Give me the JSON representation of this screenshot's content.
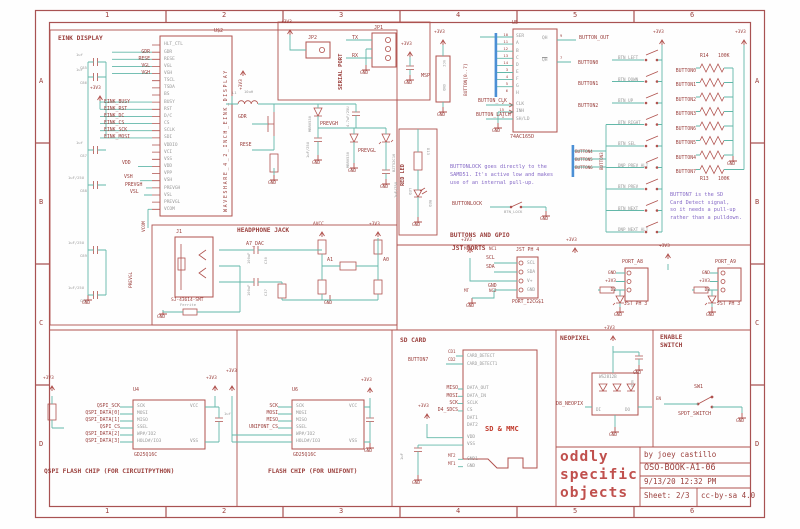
{
  "palette": {
    "symbol_red": "#b0524e",
    "label_maroon": "#9a3f3c",
    "wire_teal": "#63b8a9",
    "bus_blue": "#4b8fd5",
    "pin_gray": "#9a9a9a",
    "note_purple": "#8569c6",
    "logo_red": "#c0504d"
  },
  "sym": {
    "gnd": "GND",
    "v33": "+3V3",
    "avcc": "AVCC"
  },
  "frame": {
    "cols": [
      "1",
      "2",
      "3",
      "4",
      "5",
      "6"
    ],
    "rows": [
      "A",
      "B",
      "C",
      "D"
    ]
  },
  "title_block": {
    "logo": [
      "oddly",
      "specific",
      "objects"
    ],
    "by": "by joey castillo",
    "doc": "OSO-BOOK-A1-06",
    "date": "9/13/20 12:32 PM",
    "sheet_label": "Sheet:",
    "sheet_value": "2/3",
    "license": "cc-by-sa 4.0"
  },
  "eink": {
    "section": "EINK DISPLAY",
    "refdes": "U$2",
    "device": "WAVESHARE_4_2_INCH_EINK_DISPLAY",
    "pins": [
      "HLT_CTL",
      "GDR",
      "RESE",
      "VGL",
      "VGH",
      "TSCL",
      "TSDA",
      "BS",
      "BUSY",
      "RST",
      "D/C",
      "CS",
      "SCLK",
      "SDI",
      "VDDIO",
      "VCI",
      "VSS",
      "VDD",
      "VPP",
      "VSH",
      "PREVGH",
      "VSL",
      "PREVGL",
      "VCOM"
    ],
    "nets_top": [
      "GDR",
      "RESE",
      "VGL",
      "VGH"
    ],
    "nets_spi": [
      "EINK_BUSY",
      "EINK_RST",
      "EINK_DC",
      "EINK_CS",
      "EINK_SCK",
      "EINK_MOSI"
    ],
    "net_vdd": "VDD",
    "net_vsh": "VSH",
    "net_prevgh": "PREVGH",
    "net_vsl": "VSL",
    "net_vcom": "VCOM",
    "net_prevgl": "PREVGL",
    "cap_values": [
      "1uf",
      "1uf",
      "1uf",
      "1uF/25U",
      "1uF/25U",
      "1uF/25U"
    ],
    "cap_names": [
      "C85",
      "C86",
      "C87",
      "C88",
      "C89",
      "C90"
    ]
  },
  "boost": {
    "l_ref": "L1",
    "l_val": "10uH",
    "net_gdr": "GDR",
    "net_rese": "RESE",
    "net_prevgh": "PREVGH",
    "net_prevgl": "PREVGL",
    "d1": "MBR0530",
    "d2": "MBR0530",
    "dz": "BZT52C16",
    "c1": "1uF/25U",
    "c2": "4.7uF/25U",
    "c3": "1uF/25U"
  },
  "serial": {
    "section": "SERIAL PORT",
    "jp1": "JP1",
    "jp2": "JP2",
    "tx": "TX",
    "rx": "RX"
  },
  "msp": {
    "label": "MSP",
    "vcc": "VCC",
    "gnd": "GND"
  },
  "gpio": {
    "section": "BUTTONS AND GPIO",
    "refdes": "U5",
    "device": "74AC165D",
    "pins_in": [
      "SER",
      "A",
      "B",
      "C",
      "D",
      "E",
      "F",
      "G",
      "H"
    ],
    "pin_nums_in": [
      "10",
      "11",
      "12",
      "13",
      "14",
      "3",
      "4",
      "5",
      "6"
    ],
    "pins_ctl": [
      "CLK",
      "INH",
      "SH/LD"
    ],
    "pin_nums_ctl": [
      "2",
      "15",
      "1"
    ],
    "qh": "QH",
    "qh_num": "9",
    "qhn": "QH",
    "qhn_num": "7",
    "bus": "BUTTON[0..7]",
    "net_out": "BUTTON_OUT",
    "net_clk": "BUTTON_CLK",
    "net_latch": "BUTTON_LATCH",
    "note": [
      "BUTTONLOCK goes directly to the",
      "SAMD51. It's active low and makes",
      "use of an internal pull-up."
    ],
    "net_lock": "BUTTONLOCK",
    "sw_lock": "BTN_LOCK"
  },
  "buttons": {
    "nets_left": [
      "BUTTON0",
      "BUTTON1",
      "BUTTON2"
    ],
    "bus_nets": [
      "BUTTON4",
      "BUTTON5",
      "BUTTON6"
    ],
    "net_vert": "BUTTON3",
    "switches": [
      "BTN_LEFT",
      "BTN_DOWN",
      "BTN_UP",
      "BTN_RIGHT",
      "BTN_SEL",
      "DNP_PREV_ALT",
      "BTN_PREV",
      "BTN_NEXT",
      "DNP_NEXT_ALT"
    ],
    "array_nets": [
      "BUTTON0",
      "BUTTON1",
      "BUTTON2",
      "BUTTON3",
      "BUTTON6",
      "BUTTON5",
      "BUTTON4",
      "BUTTON7"
    ],
    "r_top": "R14",
    "r_top_val": "100K",
    "r_bot": "R13",
    "r_bot_val": "100K",
    "note": [
      "BUTTON7 is the SD",
      "Card Detect signal,",
      "so it needs a pull-up",
      "rather than a pulldown."
    ]
  },
  "redled": {
    "section": "RED LED",
    "refdes": "D13",
    "led": "LED",
    "color": "RED"
  },
  "headphone": {
    "section": "HEADPHONE JACK",
    "refdes": "J1",
    "device": "SJ-43614-SMT",
    "net_dac": "A7_DAC",
    "c1": "100uF",
    "c1n": "C30",
    "c2": "100uF",
    "c2n": "C37",
    "net_a1": "A1",
    "net_a0": "A0",
    "fb": "Ferrite"
  },
  "jst": {
    "section": "JST PORTS",
    "i2c": {
      "refdes": "PORT_I2CG$1",
      "type": "JST PH 4",
      "pins": [
        "SCL",
        "SDA",
        "V+",
        "GND"
      ],
      "mt1": "MT",
      "nc1": "NC1",
      "scl": "SCL",
      "sda": "SDA",
      "gnd": "GND",
      "mt2": "MT",
      "nc2": "NC2"
    },
    "a8": {
      "refdes": "PORT_A8",
      "type": "JST PH 3",
      "nets": [
        "GND",
        "+3V3",
        "D2"
      ]
    },
    "a9": {
      "refdes": "PORT_A9",
      "type": "JST PH 3",
      "nets": [
        "GND",
        "+3V3",
        "D3"
      ]
    }
  },
  "sdcard": {
    "section": "SD CARD",
    "device": "SD & MMC",
    "pins_cd": [
      "CARD_DETECT",
      "CARD_DETECT1"
    ],
    "pins_data": [
      "DATA_OUT",
      "DATA_IN",
      "SCLK",
      "CS",
      "DAT1",
      "DAT2"
    ],
    "pins_pwr": [
      "VDD",
      "VSS"
    ],
    "pins_gnd": [
      "GND1",
      "GND"
    ],
    "net_cd1": "CD1",
    "net_cd2": "CD2",
    "net_b7": "BUTTON7",
    "nets_data": [
      "MISO",
      "MOSI",
      "SCK",
      "D4_SDCS"
    ],
    "cap": "1uF",
    "mt2": "MT2",
    "mt1": "MT1"
  },
  "neopixel": {
    "section": "NEOPIXEL",
    "device": "WS2812B",
    "vdd": "VDD",
    "di": "DI",
    "do": "DO",
    "net": "D8_NEOPIX"
  },
  "enable": {
    "section": [
      "ENABLE",
      "SWITCH"
    ],
    "refdes": "SW1",
    "net_en": "EN",
    "device": "SPDT_SWITCH"
  },
  "qspi": {
    "refdes": "U4",
    "device": "GD25Q16C",
    "pins": [
      "SCK",
      "MOSI",
      "MISO",
      "SSEL",
      "WP#/IO2",
      "HOLD#/IO3"
    ],
    "vcc": "VCC",
    "vss": "VSS",
    "nets": [
      "QSPI_SCK",
      "QSPI_DATA[0]",
      "QSPI_DATA[1]",
      "QSPI_CS",
      "QSPI_DATA[2]",
      "QSPI_DATA[3]"
    ],
    "cap": "1uf",
    "caption": "QSPI FLASH CHIP (FOR CIRCUITPYTHON)"
  },
  "unifont": {
    "refdes": "U6",
    "device": "GD25Q16C",
    "pins": [
      "SCK",
      "MOSI",
      "MISO",
      "SSEL",
      "WP#/IO2",
      "HOLD#/IO3"
    ],
    "vcc": "VCC",
    "vss": "VSS",
    "nets": [
      "SCK",
      "MOSI",
      "MISO",
      "UNIFONT_CS"
    ],
    "caption": "FLASH CHIP (FOR UNIFONT)"
  }
}
